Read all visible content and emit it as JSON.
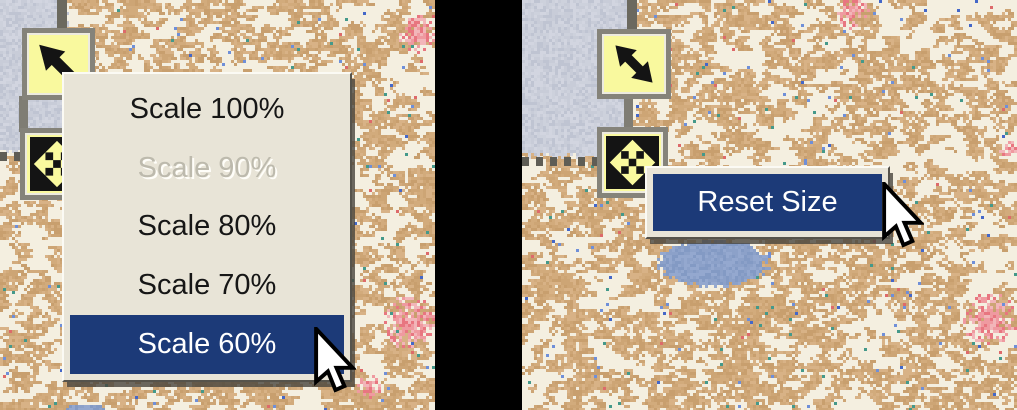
{
  "left_screenshot": {
    "handles": {
      "top_icon": "resize-nw-arrow",
      "bottom_icon": "expand-four-way-arrows"
    },
    "context_menu": {
      "items": [
        {
          "label": "Scale 100%",
          "state": "normal"
        },
        {
          "label": "Scale 90%",
          "state": "disabled"
        },
        {
          "label": "Scale 80%",
          "state": "normal"
        },
        {
          "label": "Scale 70%",
          "state": "normal"
        },
        {
          "label": "Scale 60%",
          "state": "selected"
        }
      ]
    }
  },
  "right_screenshot": {
    "handles": {
      "top_icon": "resize-nw-se-double-arrow",
      "bottom_icon": "expand-four-way-arrows"
    },
    "context_menu": {
      "items": [
        {
          "label": "Reset Size",
          "state": "selected"
        }
      ]
    }
  },
  "colors": {
    "selection_highlight": "#1c3a78",
    "menu_background": "#e8e4d7",
    "menu_text": "#161616",
    "menu_disabled_text": "#bdbaad",
    "handle_yellow": "#f9f99e",
    "handle_frame_gray": "#85837a",
    "map_cream": "#f4efe0",
    "map_tan": "#d2ab7c",
    "terrain_blue_gray": "#c8ccd8",
    "lake_blue": "#8ca1c9",
    "divider_black": "#000000"
  }
}
